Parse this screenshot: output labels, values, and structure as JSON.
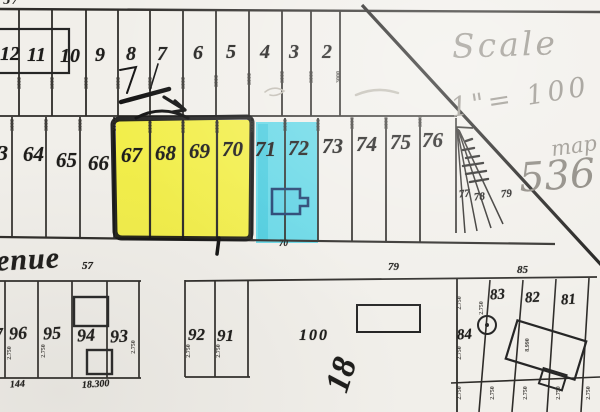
{
  "highlights": {
    "yellow": "#f2ee3c",
    "blue": "#4fd3e6",
    "navy_outline": "#1e3e6e"
  },
  "handwriting": {
    "scale_word": "Scale",
    "scale_value": "1\"= 100",
    "map_word": "map",
    "map_number": "536",
    "rotated_note": "18"
  },
  "streets": {
    "avenue_label": "enue",
    "corner_label": "57",
    "avenue_number": "57",
    "marker_79": "79",
    "marker_85": "85"
  },
  "top_row": {
    "lots": [
      "12",
      "11",
      "10",
      "9",
      "8",
      "7",
      "6",
      "5",
      "4",
      "3",
      "2"
    ]
  },
  "middle_row": {
    "lots": [
      "63",
      "64",
      "65",
      "66",
      "67",
      "68",
      "69",
      "70",
      "71",
      "72",
      "73",
      "74",
      "75",
      "76"
    ],
    "fan_lots": [
      "77",
      "78",
      "79"
    ],
    "below_blue_label": "70"
  },
  "bottom": {
    "left_block": {
      "partial_lot": "7",
      "lots": [
        "96",
        "95",
        "94",
        "93"
      ],
      "note_left": "144",
      "note_right": "18.300"
    },
    "mid_block": {
      "lots": [
        "92",
        "91"
      ]
    },
    "lot_100": {
      "label": "100"
    },
    "right_block": {
      "lots": [
        "84",
        "83",
        "82",
        "81"
      ]
    }
  },
  "dims": {
    "band": "3000",
    "lot": "2.750",
    "building": "8.990"
  }
}
